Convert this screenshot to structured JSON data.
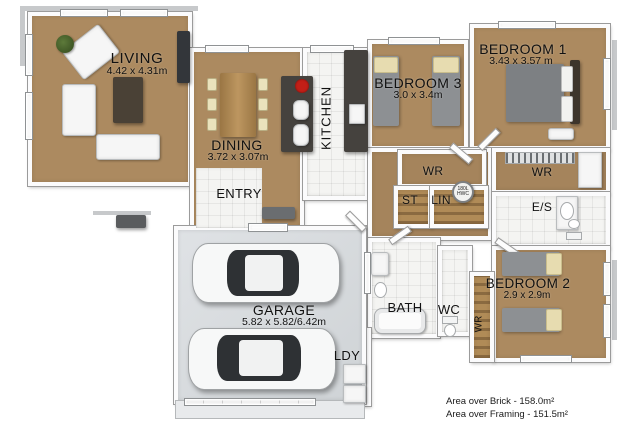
{
  "floorplan": {
    "rooms": {
      "living": {
        "label": "LIVING",
        "dims": "4.42 x 4.31m"
      },
      "dining": {
        "label": "DINING",
        "dims": "3.72 x 3.07m"
      },
      "kitchen": {
        "label": "KITCHEN"
      },
      "entry": {
        "label": "ENTRY"
      },
      "bedroom3": {
        "label": "BEDROOM 3",
        "dims": "3.0 x 3.4m"
      },
      "bedroom1": {
        "label": "BEDROOM 1",
        "dims": "3.43 x 3.57 m"
      },
      "bedroom2": {
        "label": "BEDROOM 2",
        "dims": "2.9 x 2.9m"
      },
      "garage": {
        "label": "GARAGE",
        "dims": "5.82 x 5.82/6.42m"
      },
      "bath": {
        "label": "BATH"
      },
      "wc": {
        "label": "WC"
      },
      "ensuite": {
        "label": "E/S"
      },
      "laundry": {
        "label": "LDY"
      },
      "wr_hall": {
        "label": "WR"
      },
      "wr_master": {
        "label": "WR"
      },
      "wr_bed2": {
        "label": "WR"
      },
      "store": {
        "label": "ST"
      },
      "linen": {
        "label": "LIN"
      }
    },
    "hwc": {
      "capacity": "180L",
      "type": "HWC"
    },
    "annotations": {
      "area_over_brick": "Area over Brick - 158.0m²",
      "area_over_framing": "Area over Framing - 151.5m²"
    },
    "colors": {
      "carpet": "#ac8a60",
      "tile_floor": "#f4f4f2",
      "garage_floor": "#d7dadd",
      "driveway": "#e8eaec",
      "wall": "#ffffff",
      "wall_edge": "#9b9b9b",
      "counter": "#45423e",
      "timber": "#a8834f",
      "bed_linen_gray": "#8d9093",
      "pillow_cream": "#e7dcb0",
      "cooktop_red": "#c21f17",
      "text": "#1a1a1a"
    }
  }
}
